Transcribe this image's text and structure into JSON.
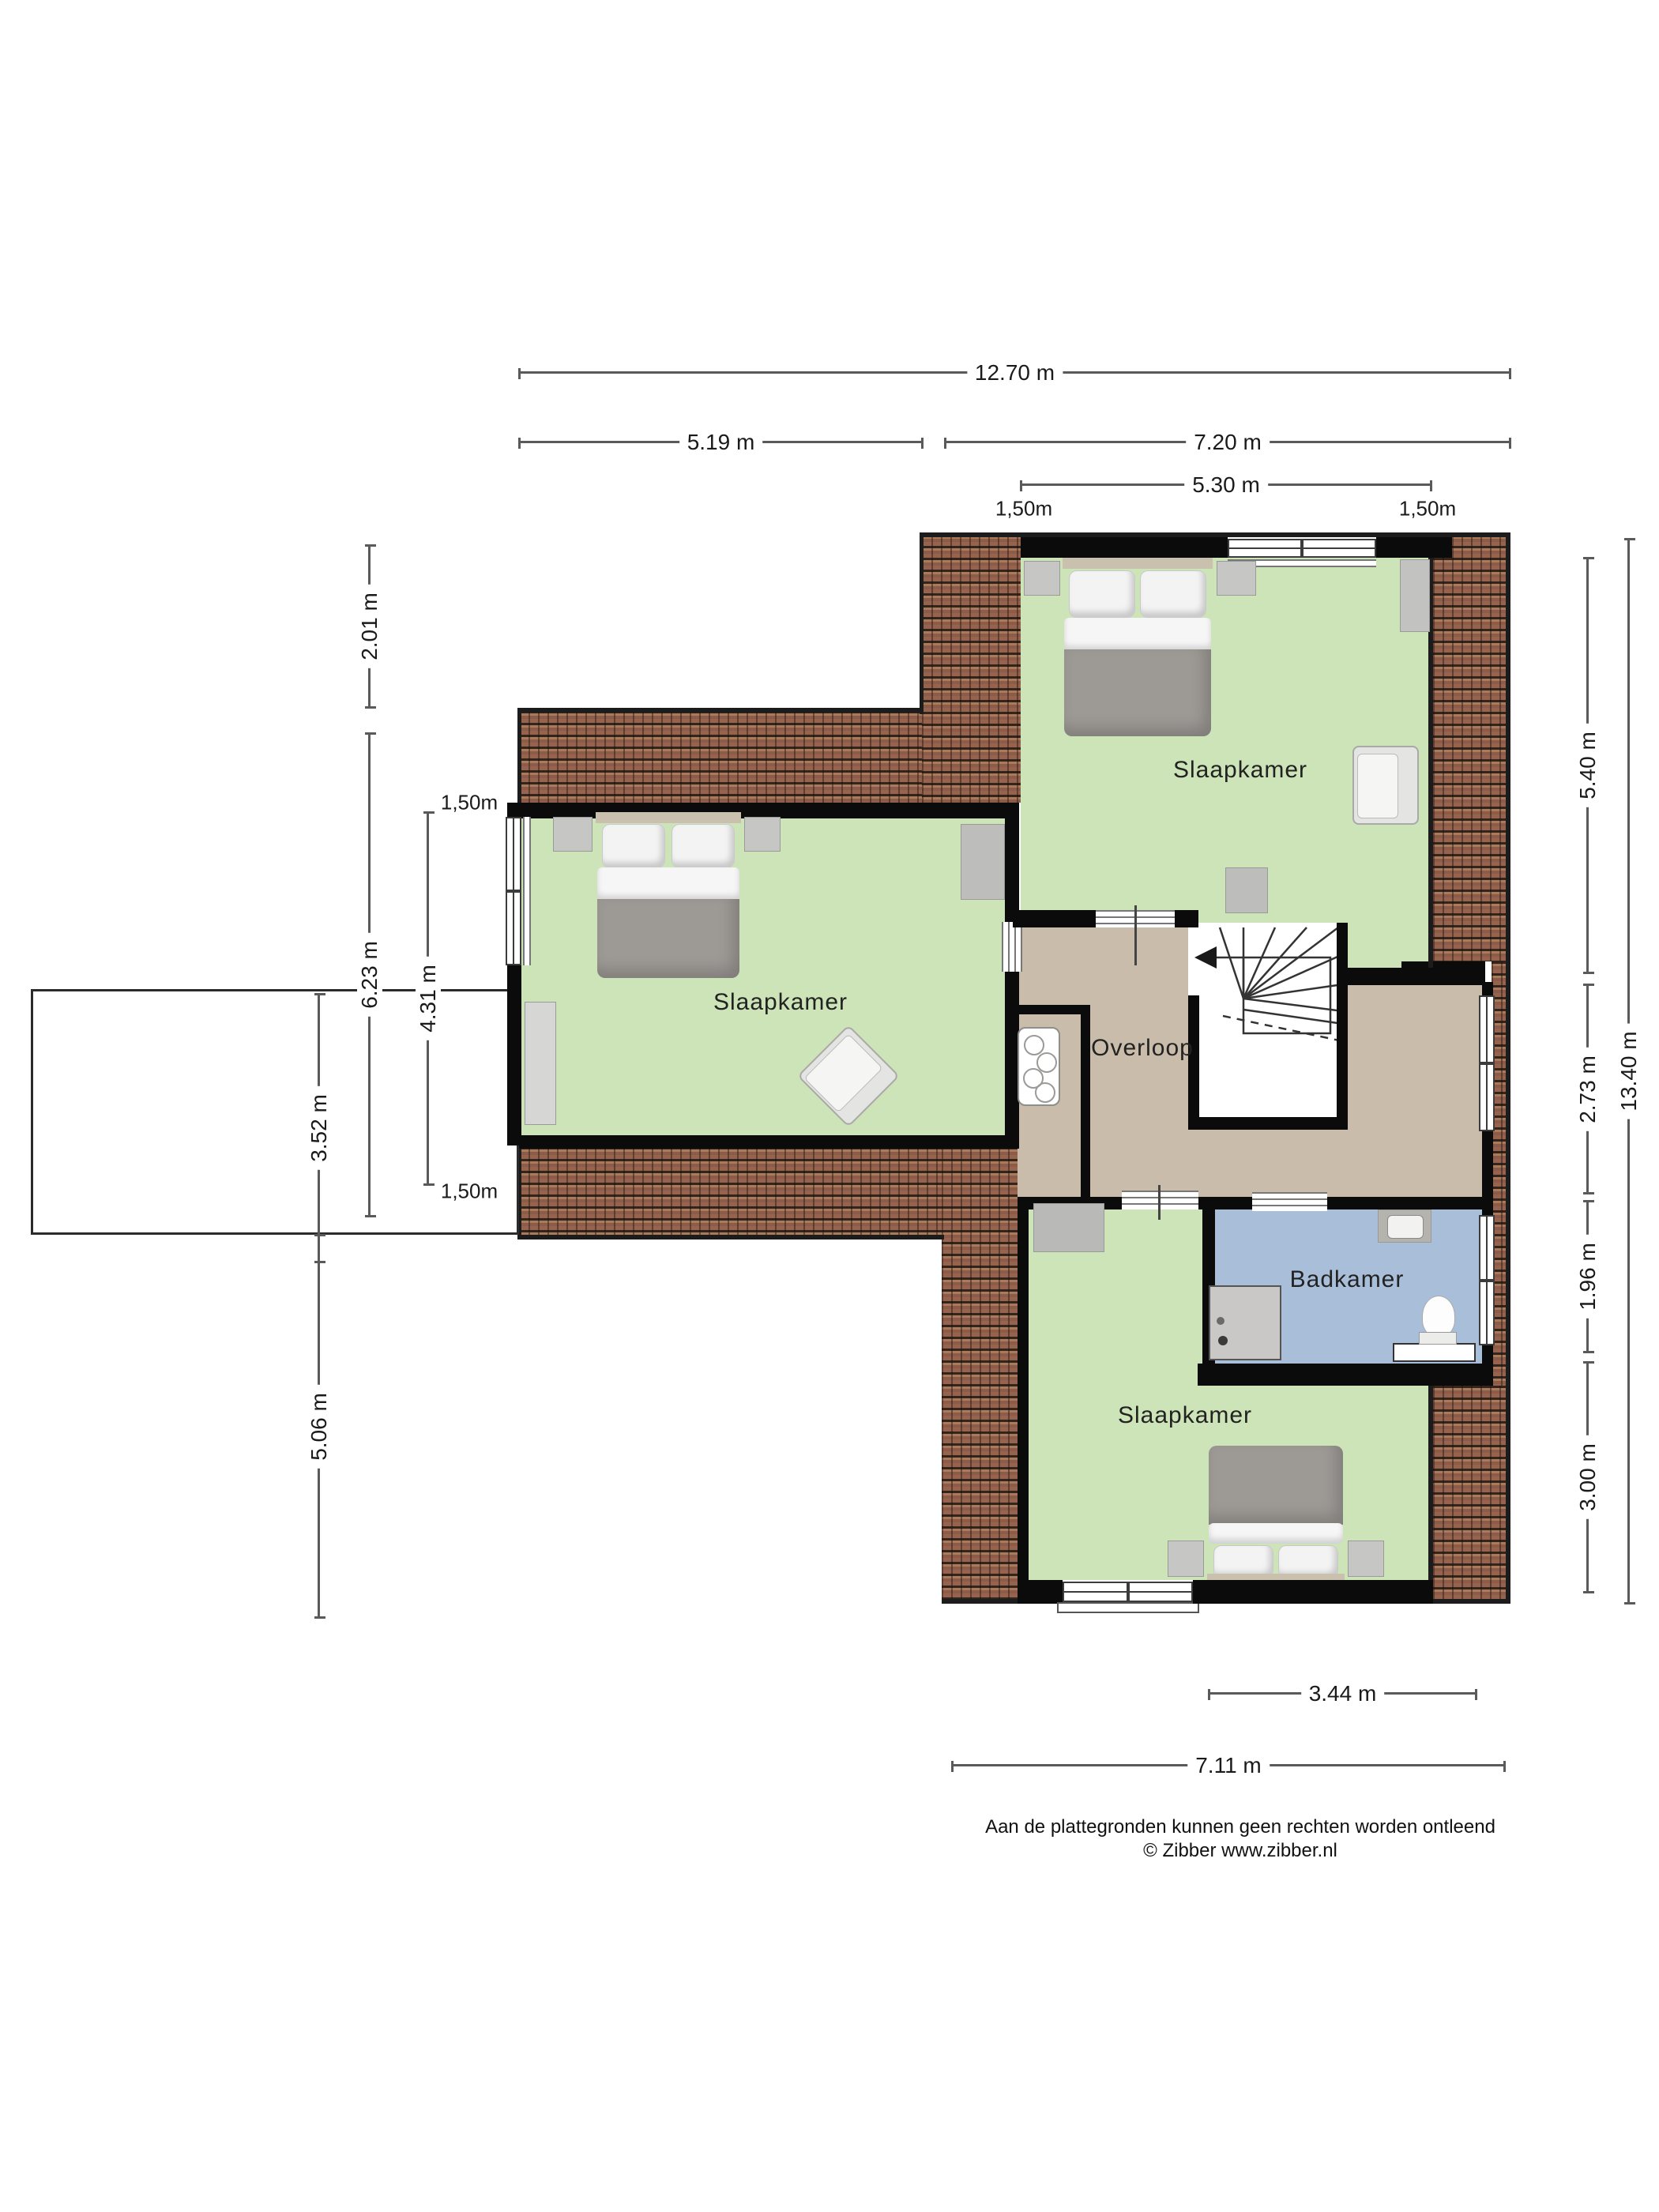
{
  "rooms": {
    "bedroom_top": {
      "label": "Slaapkamer"
    },
    "bedroom_left": {
      "label": "Slaapkamer"
    },
    "bedroom_bottom": {
      "label": "Slaapkamer"
    },
    "landing": {
      "label": "Overloop"
    },
    "bathroom": {
      "label": "Badkamer"
    }
  },
  "dimensions": {
    "top_total": "12.70 m",
    "top_left_wing": "5.19 m",
    "top_right_wing": "7.20 m",
    "top_window_wall": "5.30 m",
    "top_offset_left": "1,50m",
    "top_offset_right": "1,50m",
    "left_upper": "2.01 m",
    "left_wing_height": "6.23 m",
    "left_room_inner": "4.31 m",
    "left_offset_top": "1,50m",
    "left_offset_bottom": "1,50m",
    "left_annex": "3.52 m",
    "left_lower": "5.06 m",
    "right_bedroom": "5.40 m",
    "right_landing": "2.73 m",
    "right_bathroom": "1.96 m",
    "right_bedroom_bottom": "3.00 m",
    "right_total": "13.40 m",
    "bottom_inner": "3.44 m",
    "bottom_total": "7.11 m"
  },
  "footer": {
    "line1": "Aan de plattegronden kunnen geen rechten worden ontleend",
    "line2": "© Zibber www.zibber.nl"
  },
  "colors": {
    "bedroom_green": "#cde4b8",
    "landing_tan": "#c9bcaa",
    "bathroom_blue": "#a9bfd9",
    "roof_brown": "#8d5c49",
    "wall_black": "#0b0b0b",
    "furniture_gray": "#c6c6c4",
    "duvet_gray": "#9d9995"
  }
}
